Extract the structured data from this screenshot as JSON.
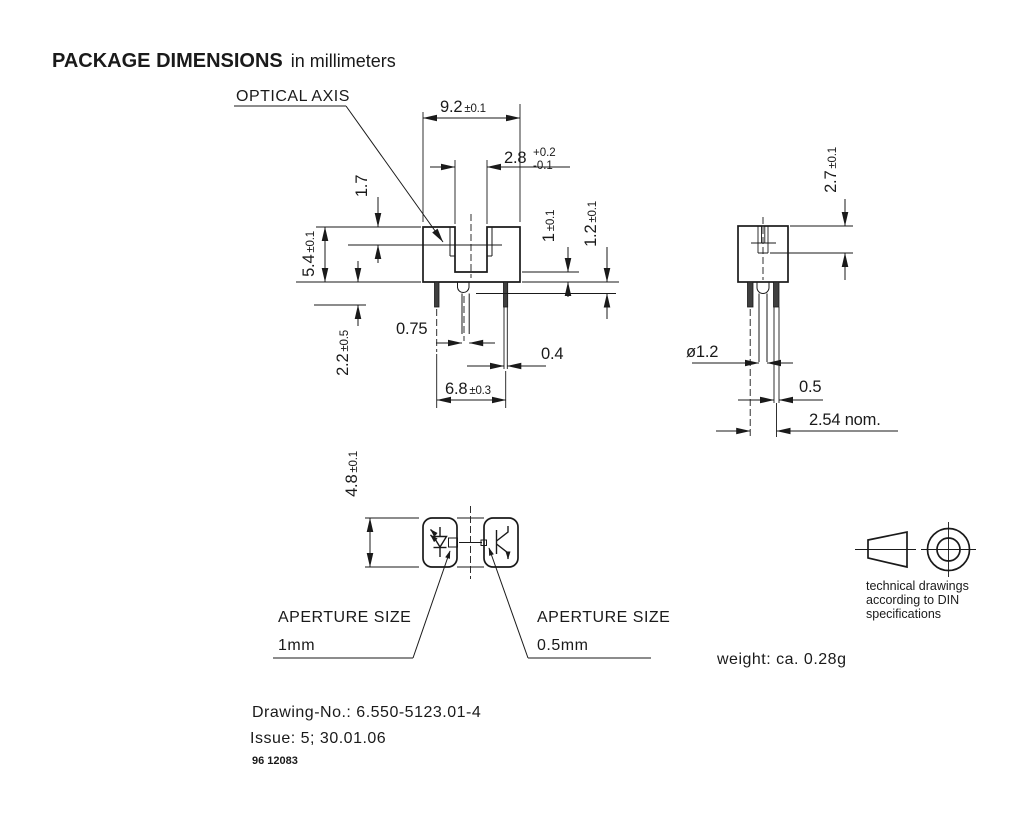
{
  "title": {
    "main": "PACKAGE DIMENSIONS",
    "suffix": "in millimeters"
  },
  "front_view": {
    "optical_axis_label": "OPTICAL AXIS",
    "width": {
      "value": "9.2",
      "tol": "±0.1"
    },
    "slot_width": {
      "value": "2.8",
      "tol_plus": "+0.2",
      "tol_minus": "-0.1"
    },
    "axis_from_top": {
      "value": "1.7"
    },
    "height": {
      "value": "5.4",
      "tol": "±0.1"
    },
    "standoff": {
      "value": "2.2",
      "tol": "±0.5"
    },
    "slot_floor": {
      "value": "1",
      "tol": "±0.1"
    },
    "boss_height": {
      "value": "1.2",
      "tol": "±0.1"
    },
    "center_lead_width": {
      "value": "0.75"
    },
    "outer_lead_width": {
      "value": "0.4"
    },
    "lead_span": {
      "value": "6.8",
      "tol": "±0.3"
    }
  },
  "side_view": {
    "aperture_depth": {
      "value": "2.7",
      "tol": "±0.1"
    },
    "boss_diameter": {
      "value": "ø1.2"
    },
    "lead_thickness": {
      "value": "0.5"
    },
    "lead_pitch": {
      "value": "2.54 nom."
    }
  },
  "bottom_view": {
    "depth": {
      "value": "4.8",
      "tol": "±0.1"
    },
    "aperture_left": {
      "line1": "APERTURE SIZE",
      "line2": "1mm"
    },
    "aperture_right": {
      "line1": "APERTURE SIZE",
      "line2": "0.5mm"
    }
  },
  "notes": {
    "projection": {
      "line1": "technical drawings",
      "line2": "according to DIN",
      "line3": "specifications"
    },
    "weight": "weight: ca. 0.28g",
    "drawing_no": "Drawing-No.: 6.550-5123.01-4",
    "issue": "Issue: 5;  30.01.06",
    "doc_code": "96 12083"
  }
}
